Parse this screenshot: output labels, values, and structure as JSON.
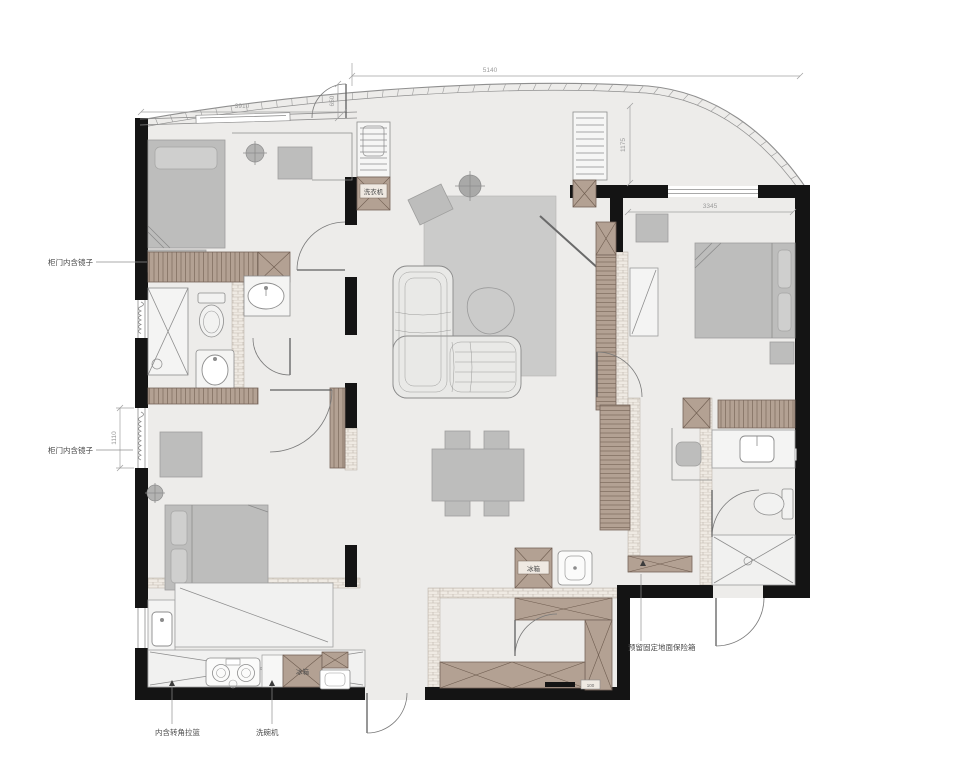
{
  "meta": {
    "title": "apartment floor plan"
  },
  "colors": {
    "wall": "#141414",
    "floor": "#edecea",
    "wood_cabinet": "#b3a193",
    "wood_line": "#76655a",
    "furniture": "#bdbdbc",
    "rug": "#cbcbca",
    "brick": "#efeae3",
    "dim_text": "#9b9b9b"
  },
  "dimensions": {
    "top_width": "5140",
    "bedroom_left_width": "3910",
    "facade_gap": "650",
    "entry_depth": "1175",
    "bedroom_right_width": "3345",
    "left_window_height": "1110"
  },
  "annotations": {
    "mirror_cabinet_top": "柜门内含镜子",
    "mirror_cabinet_bottom": "柜门内含镜子",
    "corner_pullout_basket": "内含转角拉篮",
    "dishwasher": "洗碗机",
    "washing_machine": "洗衣机",
    "fridge_kitchen": "冰箱",
    "fridge_hall": "冰箱",
    "floor_safe": "预留固定地面保险箱",
    "scale_note": "100"
  }
}
